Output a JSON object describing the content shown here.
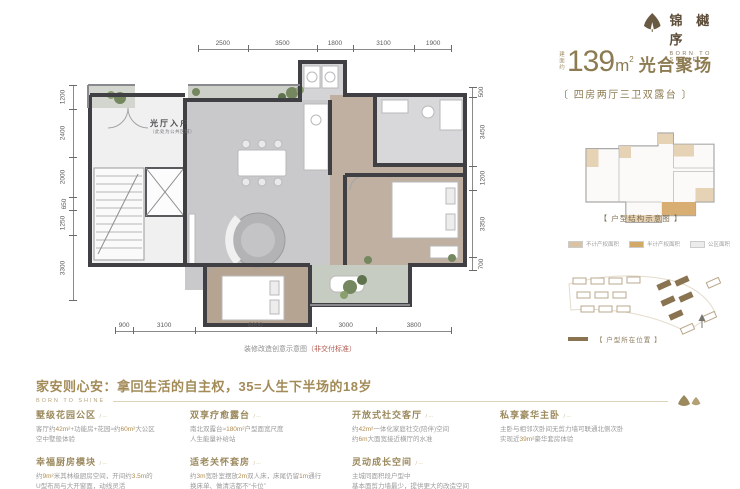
{
  "logo": {
    "name": "锦 樾 序",
    "tagline": "BORN TO SHINE"
  },
  "title": {
    "prefix": "建面约",
    "area": "139",
    "unit": "m",
    "sup": "2",
    "suffix": "光合聚场",
    "subtitle": "〔 四房两厅三卫双露台 〕"
  },
  "plan": {
    "entry_label": "光厅入户",
    "entry_note": "（此处为公共区域）",
    "caption": "装修改造创意示意图",
    "caption_note": "（非交付标准）",
    "dims": {
      "top": [
        "2500",
        "3500",
        "1800",
        "3100",
        "1900"
      ],
      "left": [
        "1200",
        "2400",
        "2000",
        "650",
        "1250",
        "3300"
      ],
      "right": [
        "500",
        "3450",
        "1200",
        "3350",
        "700"
      ],
      "bottom": [
        "900",
        "3100",
        "6000",
        "3000",
        "3800"
      ]
    }
  },
  "structure": {
    "caption": "【 户型结构示意图 】",
    "legend": [
      {
        "label": "不计产权面积",
        "color": "#d9c3a4"
      },
      {
        "label": "半计产权面积",
        "color": "#d3a968"
      },
      {
        "label": "公区面积",
        "color": "#ececec"
      }
    ]
  },
  "location": {
    "caption": "【 户型所在位置 】",
    "swatch_color": "#8a7350"
  },
  "footer": {
    "headline": "家安则心安：拿回生活的自主权，35=人生下半场的18岁",
    "brand": "BORN TO SHINE",
    "columns": [
      [
        {
          "title": "墅级花园公区",
          "tag": "⋯",
          "body": [
            "客厅约42m²+功能房+花园≈约60m²大公区",
            "空中墅般体验"
          ]
        },
        {
          "title": "幸福厨房模块",
          "tag": "⋯",
          "body": [
            "约9m²米其林级厨房空间，开间约3.5m的",
            "U型布局与大开窗面，动线灵活"
          ]
        }
      ],
      [
        {
          "title": "双享疗愈露台",
          "tag": "⋯",
          "body": [
            "南北双露台≈180m²户型面宽尺度",
            "人生能量补给站"
          ]
        },
        {
          "title": "适老关怀套房",
          "tag": "⋯",
          "body": [
            "约3m宽卧室摆放2m双人床，床尾仍留1m通行",
            "换床单、做清洁都不“卡位”"
          ]
        }
      ],
      [
        {
          "title": "开放式社交客厅",
          "tag": "⋯",
          "body": [
            "约42m²一体化家庭社交(陪伴)空间",
            "约6m大面宽接近横厅的水准"
          ]
        },
        {
          "title": "灵动成长空间",
          "tag": "⋯",
          "body": [
            "主城同面积段户型中",
            "基本面剪力墙最少，提供更大的改造空间"
          ]
        }
      ],
      [
        {
          "title": "私享豪华主卧",
          "tag": "⋯",
          "body": [
            "主卧与相邻次卧间无剪力墙可联通北侧次卧",
            "实现近39m²豪华套房体验"
          ]
        }
      ]
    ]
  },
  "colors": {
    "gold_text": "#8d7b52",
    "headline_gold": "#a38b58",
    "wall": "#3f3f44",
    "marble_floor": "#c9c9cb",
    "wood_floor": "#baa896",
    "plant_green": "#74875f",
    "location_brown": "#8a7350",
    "note_red": "#b05a50"
  }
}
